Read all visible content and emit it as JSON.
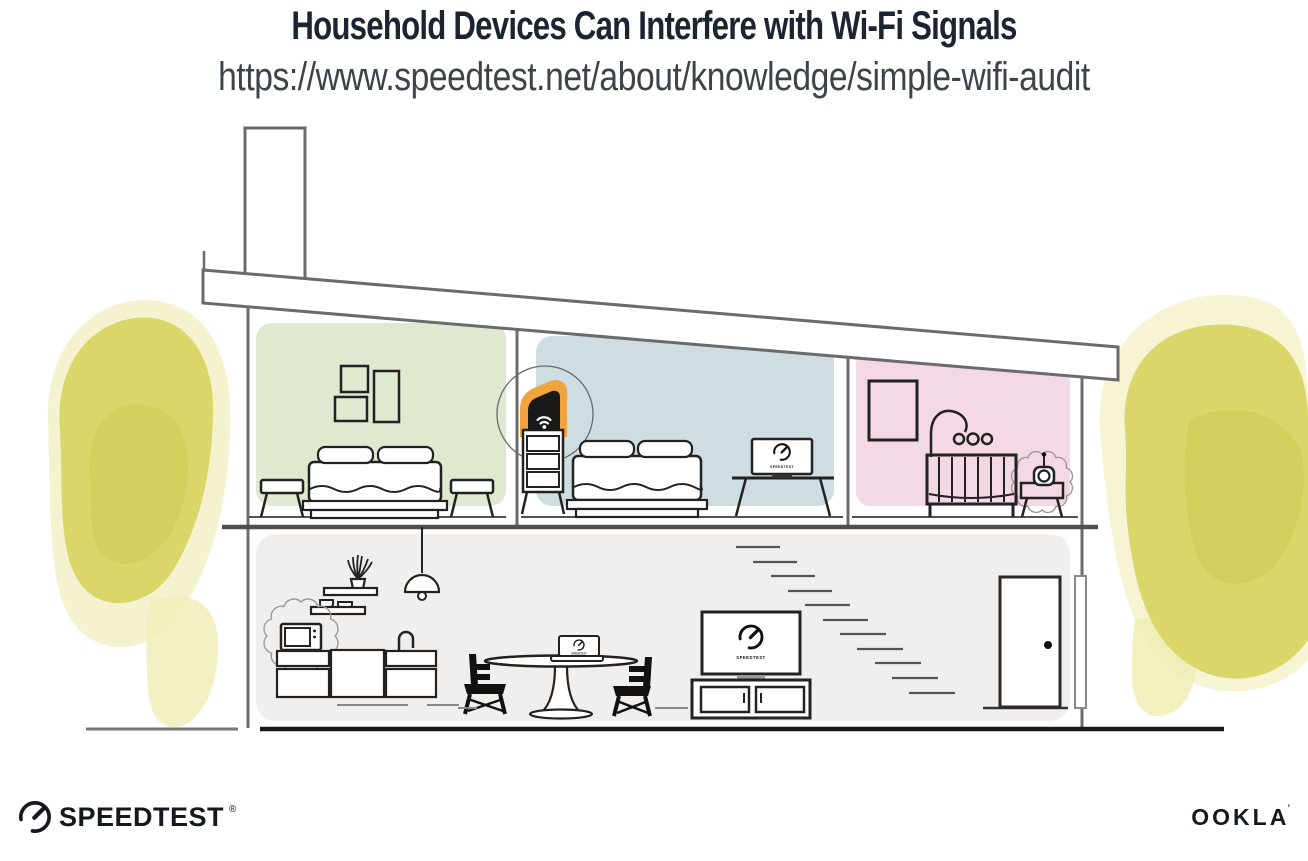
{
  "header": {
    "title": "Household Devices Can Interfere with Wi-Fi Signals",
    "url": "https://www.speedtest.net/about/knowledge/simple-wifi-audit"
  },
  "illustration": {
    "screens": {
      "bedroom_monitor_label": "SPEEDTEST",
      "tv_label": "SPEEDTEST",
      "dining_laptop_label": "SPEEDTEST"
    }
  },
  "footer": {
    "speedtest_wordmark": "SPEEDTEST",
    "speedtest_reg_mark": "®",
    "ookla_wordmark": "OOKLA",
    "ookla_mark": "’"
  },
  "colors": {
    "title_text": "#1c2431",
    "url_text": "#3e434b",
    "bedroom_green": "#dee9d0",
    "bedroom_blue": "#cddde1",
    "nursery_pink": "#f4d8e5",
    "ground_floor_gray": "#f1efed",
    "router_highlight_orange": "#f1a340",
    "tree_yellow": "#d8d464",
    "structure_line": "#6b6b6b",
    "furniture_line": "#222222"
  }
}
